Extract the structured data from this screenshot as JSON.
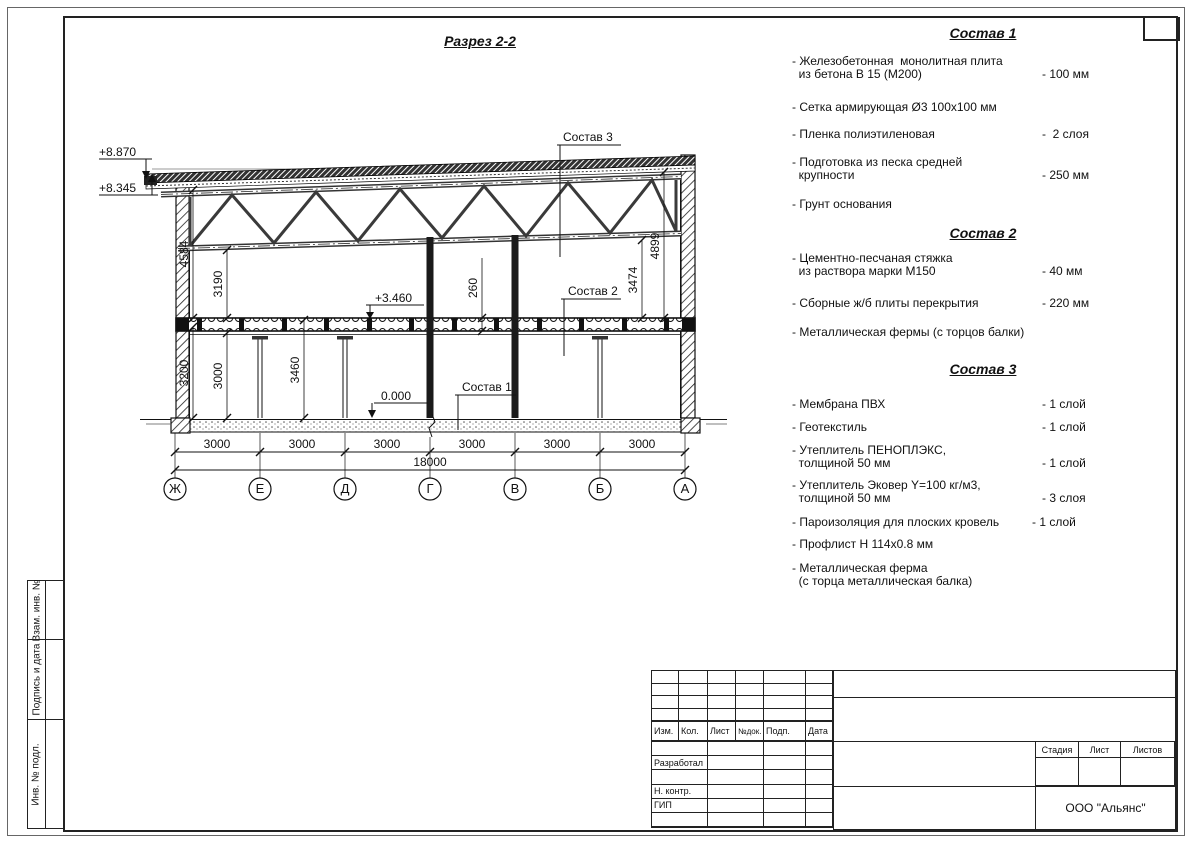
{
  "drawing": {
    "title": "Разрез 2-2",
    "elevations": {
      "roof_high": "+8.870",
      "roof_low": "+8.345",
      "floor2": "+3.460",
      "ground": "0.000"
    },
    "dims": {
      "left_outer": "4584",
      "left_inner": "3190",
      "slab_thickness": "260",
      "right_inner": "3474",
      "right_outer": "4899",
      "gf_wall": "3200",
      "gf_clear": "3000",
      "gf_full": "3460",
      "bay": "3000",
      "total": "18000"
    },
    "axes": [
      "Ж",
      "Е",
      "Д",
      "Г",
      "В",
      "Б",
      "А"
    ],
    "callouts": {
      "sostav1": "Состав 1",
      "sostav2": "Состав 2",
      "sostav3": "Состав 3"
    }
  },
  "sections": [
    {
      "title": "Состав 1",
      "items": [
        {
          "lines": [
            "- Железобетонная  монолитная плита",
            "  из бетона В 15 (М200)"
          ],
          "value": "- 100 мм"
        },
        {
          "lines": [
            "- Сетка армирующая Ø3 100х100 мм"
          ],
          "value": ""
        },
        {
          "lines": [
            "- Пленка полиэтиленовая"
          ],
          "value": "-  2 слоя"
        },
        {
          "lines": [
            "- Подготовка из песка средней",
            "  крупности"
          ],
          "value": "- 250 мм"
        },
        {
          "lines": [
            "- Грунт основания"
          ],
          "value": ""
        }
      ]
    },
    {
      "title": "Состав 2",
      "items": [
        {
          "lines": [
            "- Цементно-песчаная стяжка",
            "  из раствора марки М150"
          ],
          "value": "- 40 мм"
        },
        {
          "lines": [
            "- Сборные ж/б плиты перекрытия"
          ],
          "value": "- 220 мм"
        },
        {
          "lines": [
            "- Металлическая фермы (с торцов балки)"
          ],
          "value": ""
        }
      ]
    },
    {
      "title": "Состав 3",
      "items": [
        {
          "lines": [
            "- Мембрана ПВХ"
          ],
          "value": "- 1 слой"
        },
        {
          "lines": [
            "- Геотекстиль"
          ],
          "value": "- 1 слой"
        },
        {
          "lines": [
            "- Утеплитель ПЕНОПЛЭКС,",
            "  толщиной 50 мм"
          ],
          "value": "- 1 слой"
        },
        {
          "lines": [
            "- Утеплитель Эковер Y=100 кг/м3,",
            "  толщиной 50 мм"
          ],
          "value": "- 3 слоя"
        },
        {
          "lines": [
            "- Пароизоляция для плоских кровель"
          ],
          "value": "- 1 слой"
        },
        {
          "lines": [
            "- Профлист Н 114х0.8 мм"
          ],
          "value": ""
        },
        {
          "lines": [
            "- Металлическая ферма",
            "  (с торца металлическая балка)"
          ],
          "value": ""
        }
      ]
    }
  ],
  "titleblock": {
    "cols": [
      "Изм.",
      "Кол.",
      "Лист",
      "№док.",
      "Подп.",
      "Дата"
    ],
    "roles": [
      "Разработал",
      "Н. контр.",
      "ГИП"
    ],
    "stage_cols": [
      "Стадия",
      "Лист",
      "Листов"
    ],
    "org": "ООО \"Альянс\""
  },
  "margin_labels": [
    "Взам. инв. №",
    "Подпись и дата",
    "Инв. № подл."
  ]
}
